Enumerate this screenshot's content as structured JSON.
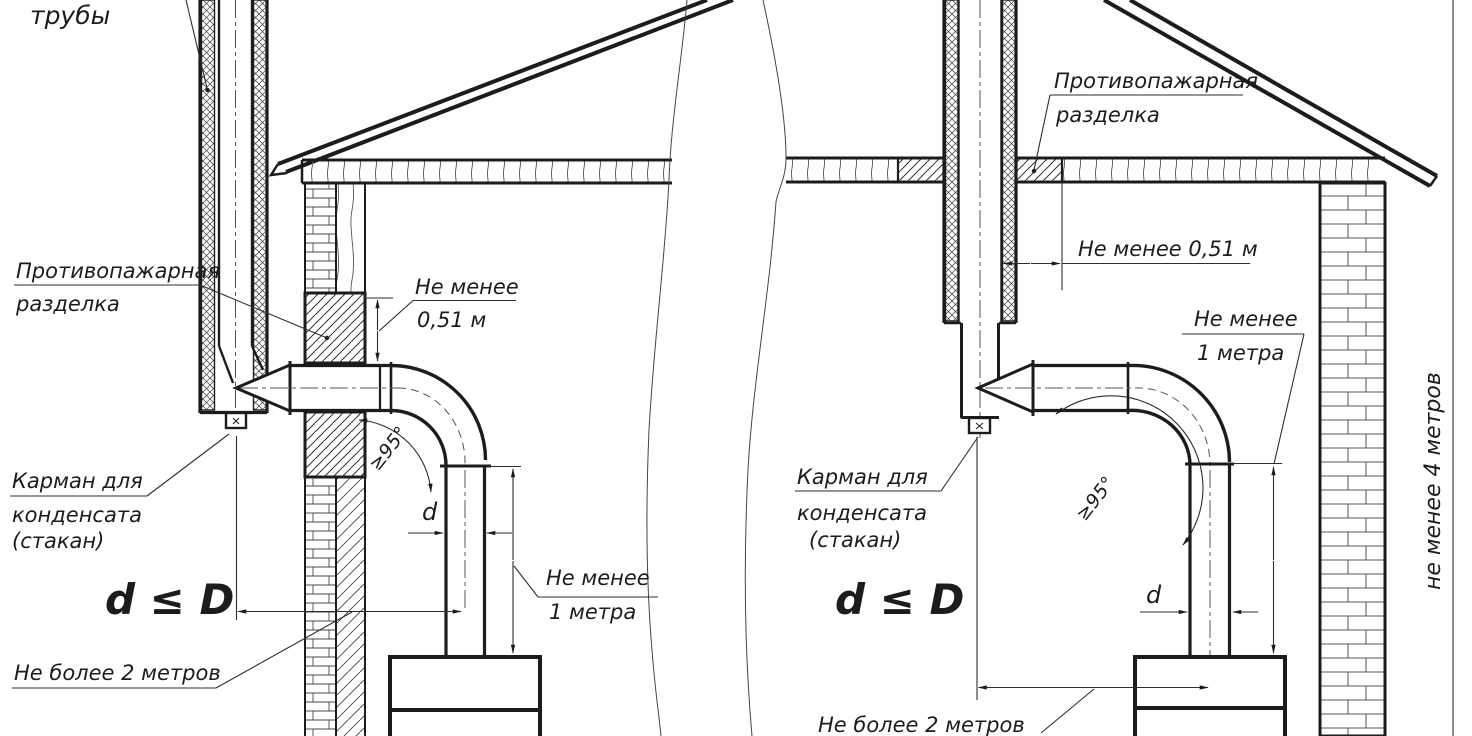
{
  "colors": {
    "ink": "#1c1c1c",
    "thin": "#2e2e2e",
    "paper": "#ffffff"
  },
  "left_diagram": {
    "pipe_insulation_label": "трубы",
    "fire_break_label": [
      "Противопажарная",
      "разделка"
    ],
    "min_height_above": [
      "Не менее",
      "0,51 м"
    ],
    "angle_label": "≥95°",
    "diameter_label": "d",
    "condensate_pocket_label": [
      "Карман для",
      "конденсата",
      "(стакан)"
    ],
    "diameter_rule": "d ≤ D",
    "max_horizontal_run": "Не более 2 метров",
    "min_vertical_run": [
      "Не менее",
      "1 метра"
    ]
  },
  "right_diagram": {
    "fire_break_label": [
      "Противопажарная",
      "разделка"
    ],
    "min_distance_to_break": "Не менее 0,51 м",
    "min_vertical_run": [
      "Не менее",
      "1 метра"
    ],
    "condensate_pocket_label": [
      "Карман для",
      "конденсата",
      "(стакан)"
    ],
    "angle_label": "≥95°",
    "diameter_label": "d",
    "diameter_rule": "d ≤ D",
    "max_horizontal_run": "Не более 2 метров",
    "min_chimney_height": "не менее 4 метров"
  }
}
